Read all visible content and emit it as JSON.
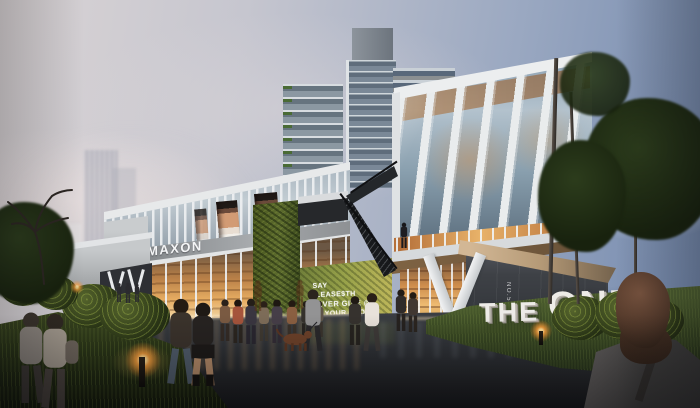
{
  "signage": {
    "maxon": "MAXON",
    "the_one": {
      "word1": "THE",
      "word2": "ONE"
    },
    "no5_vertical": "NO.5",
    "green_wall_slogan": {
      "line1": "SAY",
      "line2": "PLEASE$TH",
      "line3": "EVER GIVE @",
      "line4": "EP YOUR PROMI"
    }
  },
  "palette": {
    "sky_blue": "#7b90b4",
    "sky_haze": "#d6d0d2",
    "facade_white": "#e9ebec",
    "glass_blue": "#9fb2c2",
    "warm_interior": "#e0a050",
    "green_wall": "#8a9a45",
    "hedge_green": "#55622e",
    "lawn_green": "#45562b",
    "plaza_asphalt": "#33363a",
    "wood_soffit": "#8a6844",
    "sign_white": "#eceae6"
  }
}
